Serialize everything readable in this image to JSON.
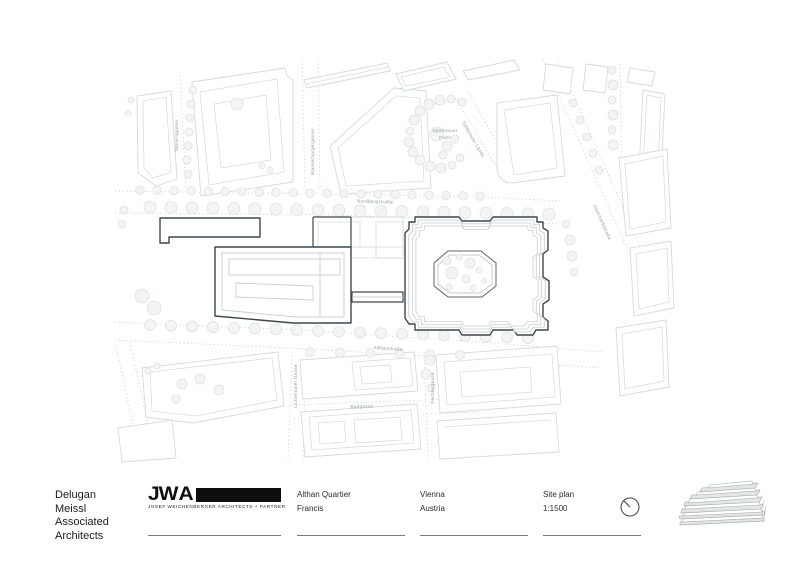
{
  "sheet": {
    "architect": {
      "lines": [
        "Delugan",
        "Meissl",
        "Associated",
        "Architects"
      ]
    },
    "logo": {
      "letters_jw": "JW",
      "letter_a": "A",
      "subtitle": "JOSEF WEICHENBERGER ARCHITECTS + PARTNER"
    },
    "project": {
      "name": "Althan Quartier",
      "subname": "Francis"
    },
    "location": {
      "city": "Vienna",
      "country": "Austria"
    },
    "drawing": {
      "title": "Site plan",
      "scale": "1:1500"
    }
  },
  "map": {
    "labels": {
      "nordbergstrasse": "Nordbergstraße",
      "althanstrasse": "Althanstraße",
      "badgasse": "Badgasse",
      "spittelauer_line1": "Spittelauer",
      "spittelauer_line2": "Platz",
      "tepserngasse": "Tepserngasse",
      "wasserburgergasse": "Wasserburgergasse",
      "spittelauer_laende": "Spittelauer Lände",
      "alserbachstrasse": "Alserbachstraße",
      "lichtentaler_gasse": "Lichtentaler Gasse",
      "fechtergasse": "Fechtergasse"
    },
    "colors": {
      "project_outline": "#3d474d",
      "context_outline": "#d5dadb",
      "dotted_line": "#c6cbce",
      "label_text": "#96a0a5"
    }
  },
  "title_block_text_color": "#1c1c1b"
}
